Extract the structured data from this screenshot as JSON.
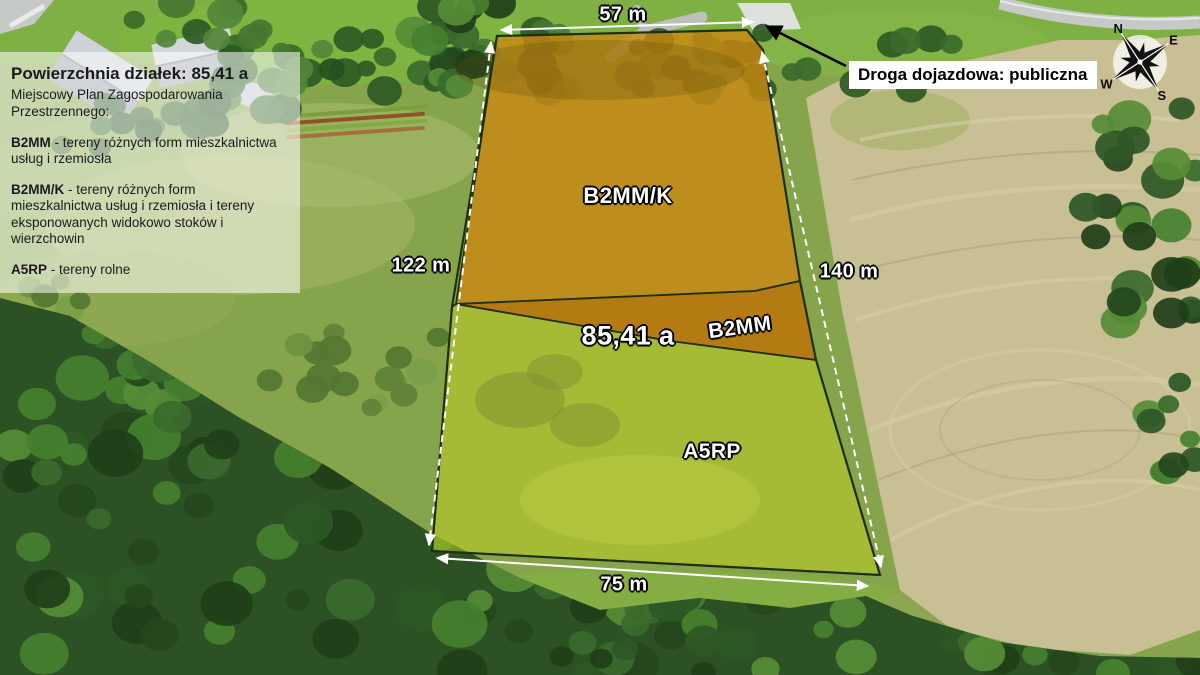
{
  "info_panel": {
    "title": "Powierzchnia działek: 85,41 a",
    "subtitle": "Miejscowy Plan Zagospodarowania Przestrzennego:",
    "legend": [
      {
        "code": "B2MM",
        "desc": "- tereny różnych form mieszkalnictwa usług i rzemiosła"
      },
      {
        "code": "B2MM/K",
        "desc": "- tereny różnych form mieszkalnictwa usług i rzemiosła i tereny eksponowanych widokowo stoków i wierzchowin"
      },
      {
        "code": "A5RP",
        "desc": "- tereny rolne"
      }
    ]
  },
  "road_callout": {
    "label": "Droga dojazdowa: publiczna"
  },
  "parcel": {
    "area_label": "85,41 a",
    "zones": [
      {
        "code": "B2MM/K"
      },
      {
        "code": "B2MM"
      },
      {
        "code": "A5RP"
      }
    ],
    "dimensions": {
      "top": "57 m",
      "left": "122 m",
      "right": "140 m",
      "bottom": "75 m"
    }
  },
  "compass": {
    "north": "N",
    "east": "E",
    "south": "S",
    "west": "W"
  },
  "colors": {
    "zone_b2mmk": "#cb8812",
    "zone_b2mm": "#c07207",
    "zone_a5rp": "#c3d122",
    "parcel_outline": "#1e3010",
    "measurement": "#ffffff",
    "callout_bg": "#ffffff",
    "callout_text": "#000000",
    "panel_bg": "rgba(255,255,255,0.55)",
    "panel_text": "#1b1b1d"
  }
}
